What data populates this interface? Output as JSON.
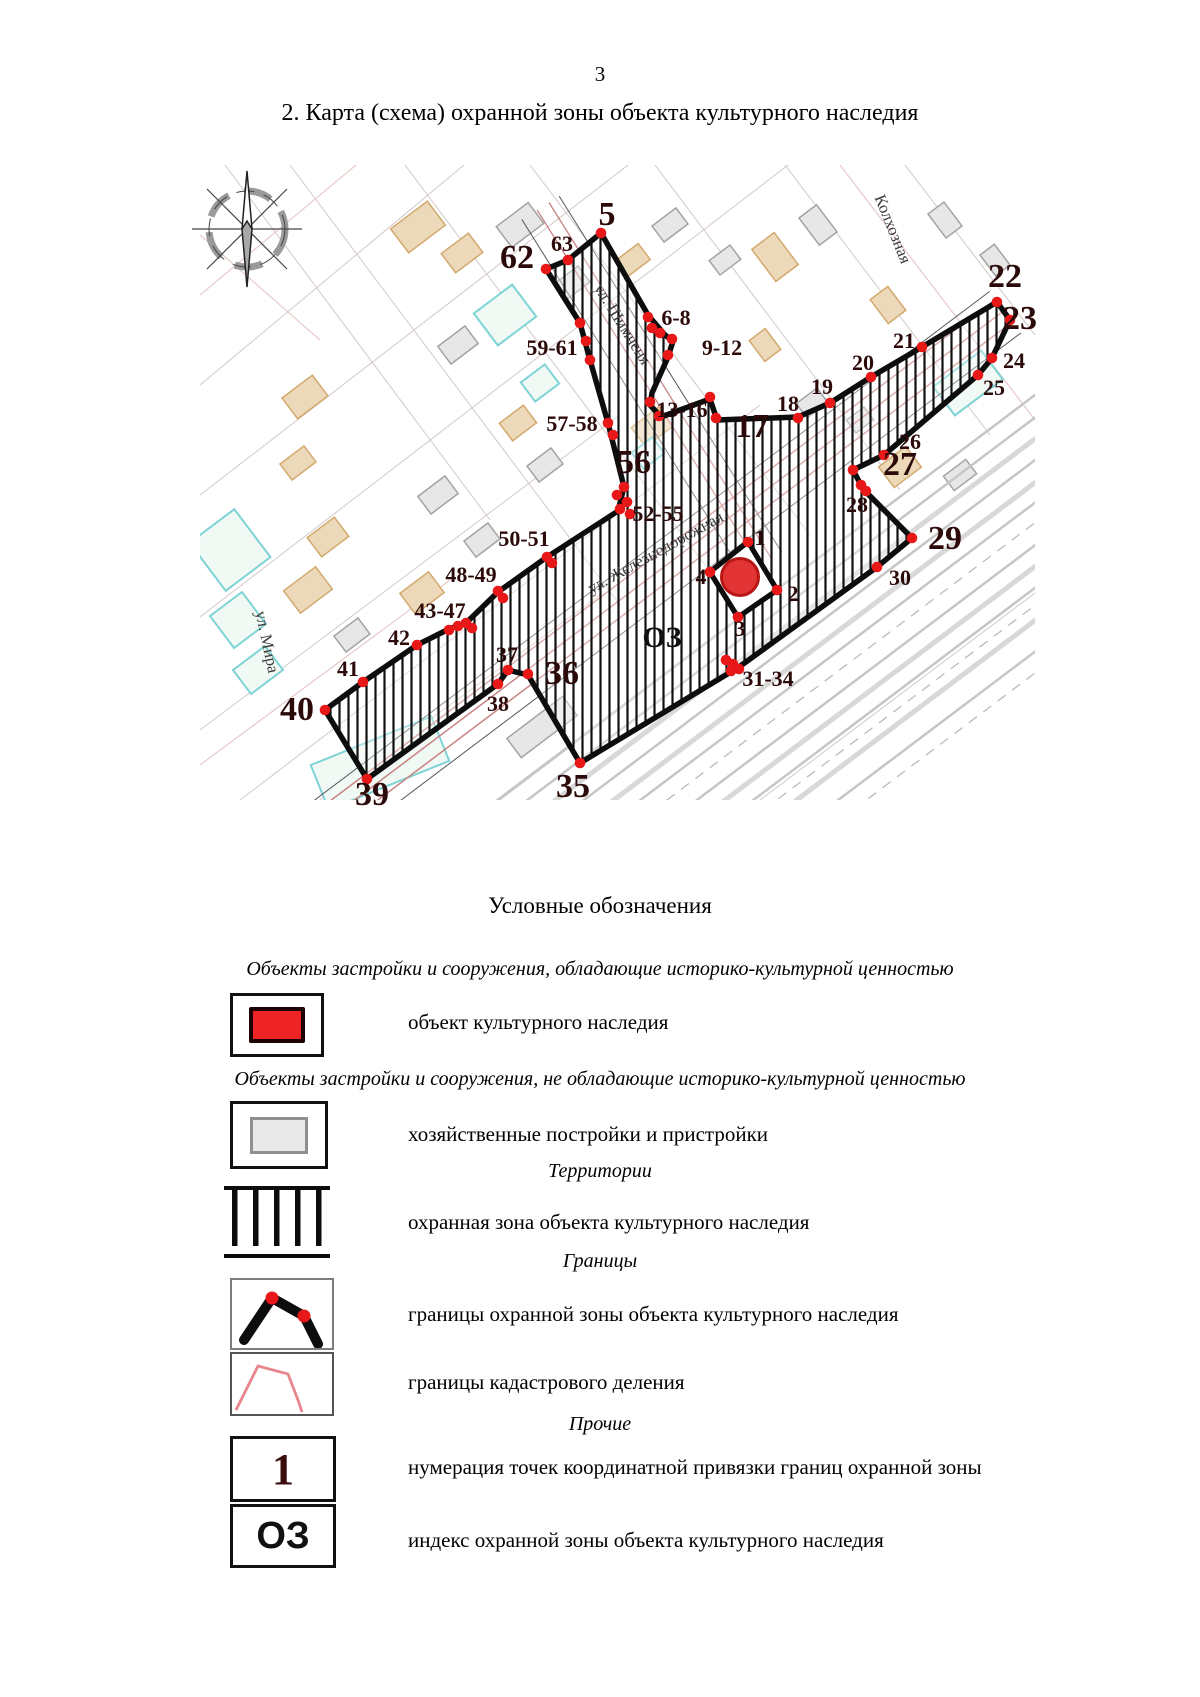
{
  "page": {
    "number": "3",
    "title": "2. Карта (схема) охранной зоны объекта культурного наследия"
  },
  "map": {
    "colors": {
      "point_red": "#e81818",
      "label_dark": "#2d0a0a",
      "zone_black": "#0d0d0d",
      "object_red": "#e23434",
      "object_red_edge": "#b81515"
    },
    "zone_index": {
      "text": "ОЗ",
      "x": 462,
      "y": 482
    },
    "street_labels": [
      {
        "text": "ул. Шимченя",
        "x": 418,
        "y": 162,
        "angle": 58
      },
      {
        "text": "ул. Железнодорожная",
        "x": 458,
        "y": 392,
        "angle": -29
      },
      {
        "text": "ул. Мира",
        "x": 62,
        "y": 478,
        "angle": 78
      },
      {
        "text": "Колхозная",
        "x": 688,
        "y": 66,
        "angle": 68
      }
    ],
    "points_big": [
      {
        "label": "5",
        "x": 407,
        "y": 60
      },
      {
        "label": "62",
        "x": 317,
        "y": 103
      },
      {
        "label": "22",
        "x": 805,
        "y": 122
      },
      {
        "label": "23",
        "x": 820,
        "y": 164
      },
      {
        "label": "17",
        "x": 552,
        "y": 272
      },
      {
        "label": "27",
        "x": 700,
        "y": 310
      },
      {
        "label": "29",
        "x": 745,
        "y": 384
      },
      {
        "label": "56",
        "x": 434,
        "y": 308
      },
      {
        "label": "36",
        "x": 362,
        "y": 519
      },
      {
        "label": "35",
        "x": 373,
        "y": 632
      },
      {
        "label": "39",
        "x": 172,
        "y": 640
      },
      {
        "label": "40",
        "x": 97,
        "y": 555
      }
    ],
    "points_small": [
      {
        "label": "63",
        "x": 362,
        "y": 86
      },
      {
        "label": "6-8",
        "x": 476,
        "y": 160
      },
      {
        "label": "9-12",
        "x": 522,
        "y": 190
      },
      {
        "label": "59-61",
        "x": 352,
        "y": 190
      },
      {
        "label": "57-58",
        "x": 372,
        "y": 266
      },
      {
        "label": "13-16",
        "x": 482,
        "y": 252
      },
      {
        "label": "18",
        "x": 588,
        "y": 246
      },
      {
        "label": "19",
        "x": 622,
        "y": 229
      },
      {
        "label": "20",
        "x": 663,
        "y": 205
      },
      {
        "label": "21",
        "x": 704,
        "y": 183
      },
      {
        "label": "24",
        "x": 814,
        "y": 203
      },
      {
        "label": "25",
        "x": 794,
        "y": 230
      },
      {
        "label": "26",
        "x": 710,
        "y": 284
      },
      {
        "label": "28",
        "x": 657,
        "y": 347
      },
      {
        "label": "30",
        "x": 700,
        "y": 420
      },
      {
        "label": "31-34",
        "x": 568,
        "y": 521
      },
      {
        "label": "37",
        "x": 307,
        "y": 497
      },
      {
        "label": "38",
        "x": 298,
        "y": 546
      },
      {
        "label": "41",
        "x": 148,
        "y": 511
      },
      {
        "label": "42",
        "x": 199,
        "y": 480
      },
      {
        "label": "43-47",
        "x": 240,
        "y": 453
      },
      {
        "label": "48-49",
        "x": 271,
        "y": 417
      },
      {
        "label": "50-51",
        "x": 324,
        "y": 381
      },
      {
        "label": "52-55",
        "x": 458,
        "y": 356
      },
      {
        "label": "1",
        "x": 560,
        "y": 380
      },
      {
        "label": "2",
        "x": 593,
        "y": 436
      },
      {
        "label": "3",
        "x": 540,
        "y": 471
      },
      {
        "label": "4",
        "x": 501,
        "y": 419
      }
    ],
    "dots": [
      [
        401,
        68
      ],
      [
        368,
        95
      ],
      [
        346,
        104
      ],
      [
        380,
        158
      ],
      [
        386,
        176
      ],
      [
        390,
        195
      ],
      [
        408,
        258
      ],
      [
        413,
        270
      ],
      [
        424,
        322
      ],
      [
        417,
        330
      ],
      [
        427,
        337
      ],
      [
        420,
        344
      ],
      [
        430,
        349
      ],
      [
        347,
        392
      ],
      [
        352,
        398
      ],
      [
        298,
        426
      ],
      [
        303,
        433
      ],
      [
        249,
        465
      ],
      [
        258,
        461
      ],
      [
        266,
        458
      ],
      [
        272,
        463
      ],
      [
        217,
        480
      ],
      [
        163,
        517
      ],
      [
        125,
        545
      ],
      [
        167,
        614
      ],
      [
        298,
        519
      ],
      [
        308,
        505
      ],
      [
        328,
        509
      ],
      [
        380,
        598
      ],
      [
        526,
        495
      ],
      [
        533,
        499
      ],
      [
        539,
        504
      ],
      [
        531,
        506
      ],
      [
        677,
        402
      ],
      [
        712,
        373
      ],
      [
        666,
        326
      ],
      [
        653,
        305
      ],
      [
        661,
        320
      ],
      [
        684,
        290
      ],
      [
        778,
        210
      ],
      [
        792,
        193
      ],
      [
        810,
        155
      ],
      [
        797,
        137
      ],
      [
        722,
        182
      ],
      [
        671,
        212
      ],
      [
        630,
        238
      ],
      [
        598,
        253
      ],
      [
        510,
        232
      ],
      [
        516,
        253
      ],
      [
        450,
        237
      ],
      [
        459,
        251
      ],
      [
        460,
        168
      ],
      [
        472,
        174
      ],
      [
        468,
        190
      ],
      [
        448,
        152
      ],
      [
        452,
        163
      ],
      [
        548,
        377
      ],
      [
        577,
        425
      ],
      [
        538,
        452
      ],
      [
        510,
        407
      ]
    ]
  },
  "legend": {
    "title": "Условные обозначения",
    "sections": [
      {
        "header": "Объекты застройки и сооружения, обладающие историко-культурной ценностью",
        "items": [
          {
            "symbol": "heritage-object",
            "label": "объект культурного наследия"
          }
        ]
      },
      {
        "header": "Объекты застройки и сооружения, не обладающие историко-культурной ценностью",
        "items": [
          {
            "symbol": "outbuilding",
            "label": "хозяйственные постройки и пристройки"
          }
        ]
      },
      {
        "header": "Территории",
        "items": [
          {
            "symbol": "protection-zone-hatch",
            "label": "охранная зона объекта культурного наследия"
          }
        ]
      },
      {
        "header": "Границы",
        "items": [
          {
            "symbol": "zone-boundary",
            "label": "границы охранной зоны объекта культурного наследия"
          },
          {
            "symbol": "cadastral-boundary",
            "label": "границы кадастрового деления"
          }
        ]
      },
      {
        "header": "Прочие",
        "items": [
          {
            "symbol": "point-number",
            "glyph": "1",
            "label": "нумерация точек координатной привязки границ охранной зоны"
          },
          {
            "symbol": "zone-index",
            "glyph": "ОЗ",
            "label": "индекс охранной зоны объекта культурного наследия"
          }
        ]
      }
    ]
  }
}
